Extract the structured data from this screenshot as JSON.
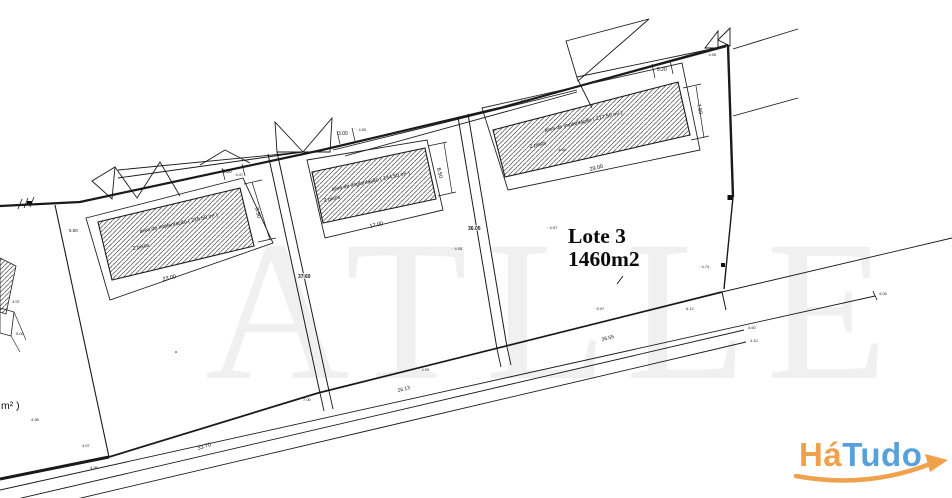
{
  "watermark": {
    "text": "ATLLE"
  },
  "plan": {
    "lot1": {
      "area_label": "área de implantação ( 216.50 m² )",
      "floors": "2 pisos",
      "width": "23.00",
      "height": "9.50",
      "top_gap": "3.00",
      "side_gap": "5.00"
    },
    "lot2": {
      "area_label": "área de implantação ( 144.50 m² )",
      "floors": "2 pisos",
      "width": "17.00",
      "height": "8.50",
      "top_gap": "3.00",
      "division_length": "37.60"
    },
    "lot3": {
      "area_label": "área de implantação ( 217.50 m² )",
      "floors": "2 pisos",
      "width": "29.00",
      "height": "7.50",
      "top_gap": "5.20",
      "division_length": "36.05",
      "title": "Lote 3",
      "area_total": "1460m2"
    },
    "road": {
      "dim1": "33.70",
      "dim2": "26.13",
      "dim3": "35.55"
    },
    "edge_label": "m² )",
    "spots": {
      "s1": "4.97",
      "s2": "5.00",
      "s3": "4.98",
      "s4": "4.07",
      "s5": "4.95",
      "s6": "· 4.47",
      "s7": "· 4.50",
      "s8": "· 4.90",
      "s9": "4.66",
      "s10": "· 4.05",
      "s11": "· 4.97",
      "s12": "· 4.74",
      "s13": "6.12",
      "s14": "· 5.07",
      "s15": "· 4.05",
      "s16": "· 4.05",
      "s17": "7.00",
      "s18": "4.05",
      "s19": "4.60",
      "s20": "4.10"
    }
  },
  "logo": {
    "part1": "Há",
    "part2": "Tudo",
    "orange": "#F0A14C",
    "blue": "#57A0D9"
  }
}
